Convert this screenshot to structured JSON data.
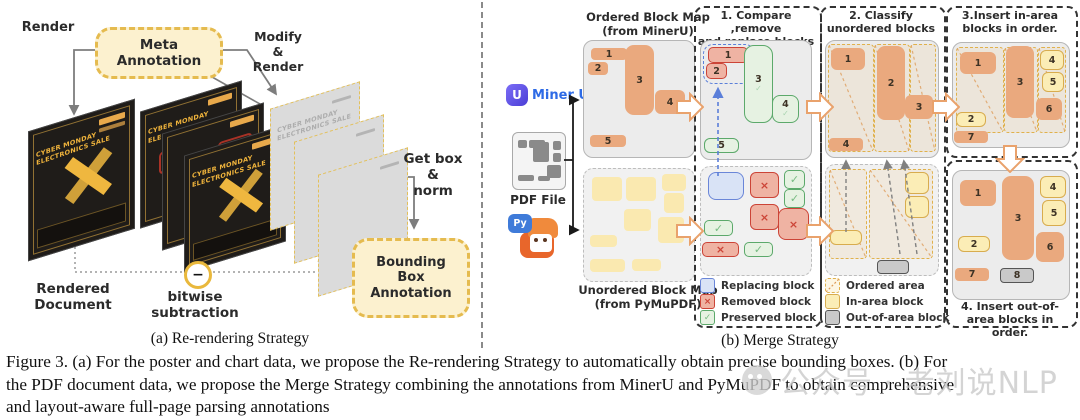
{
  "panel_a": {
    "render_label": "Render",
    "meta_box": [
      "Meta",
      "Annotation"
    ],
    "modify_lines": [
      "Modify",
      "&",
      "Render"
    ],
    "poster_title": [
      "CYBER MONDAY",
      "ELECTRONICS SALE"
    ],
    "minus_sign": "−",
    "rendered_document": [
      "Rendered",
      "Document"
    ],
    "bitwise": [
      "bitwise",
      "subtraction"
    ],
    "get_box": [
      "Get box",
      "&",
      "norm"
    ],
    "bbox_box": [
      "Bounding",
      "Box",
      "Annotation"
    ],
    "caption": "(a) Re-rendering Strategy"
  },
  "panel_b": {
    "caption": "(b) Merge Strategy",
    "mineru_label": "Miner U",
    "mineru_letter": "U",
    "pdf_label": "PDF File",
    "py_label": "Py",
    "ordered_title": [
      "Ordered Block Map",
      "(from MinerU)"
    ],
    "unordered_title": [
      "Unordered Block Map",
      "(from  PyMuPDF)"
    ],
    "ordered_blocks": [
      "1",
      "2",
      "3",
      "4",
      "5"
    ],
    "step1": {
      "title": [
        "1. Compare ,remove",
        "and replace blocks"
      ],
      "top_blocks": [
        "1",
        "2",
        "3",
        "4",
        "5"
      ],
      "x": "×",
      "check": "✓"
    },
    "step2": {
      "title": [
        "2. Classify",
        "unordered blocks"
      ],
      "top_blocks": [
        "1",
        "2",
        "3",
        "4"
      ]
    },
    "step3": {
      "title": [
        "3.Insert in-area",
        "blocks in order."
      ],
      "blocks": [
        "1",
        "2",
        "3",
        "4",
        "5",
        "6",
        "7"
      ]
    },
    "step4": {
      "title": [
        "4. Insert out-of-",
        "area blocks in order."
      ],
      "blocks": [
        "1",
        "2",
        "3",
        "4",
        "5",
        "6",
        "7",
        "8"
      ]
    },
    "legend_blocks": [
      "Replacing block",
      "Removed block",
      "Preserved block"
    ],
    "legend_areas": [
      "Ordered area",
      "In-area block",
      "Out-of-area block"
    ]
  },
  "figure_caption": [
    "Figure 3. (a) For the poster and chart data, we propose the Re-rendering Strategy to automatically obtain precise bounding boxes. (b) For",
    "the PDF document data, we propose the Merge Strategy combining the annotations from MinerU and PyMuPDF to obtain comprehensive",
    "and layout-aware full-page parsing annotations"
  ],
  "watermark": "公众号 · 老刘说NLP"
}
